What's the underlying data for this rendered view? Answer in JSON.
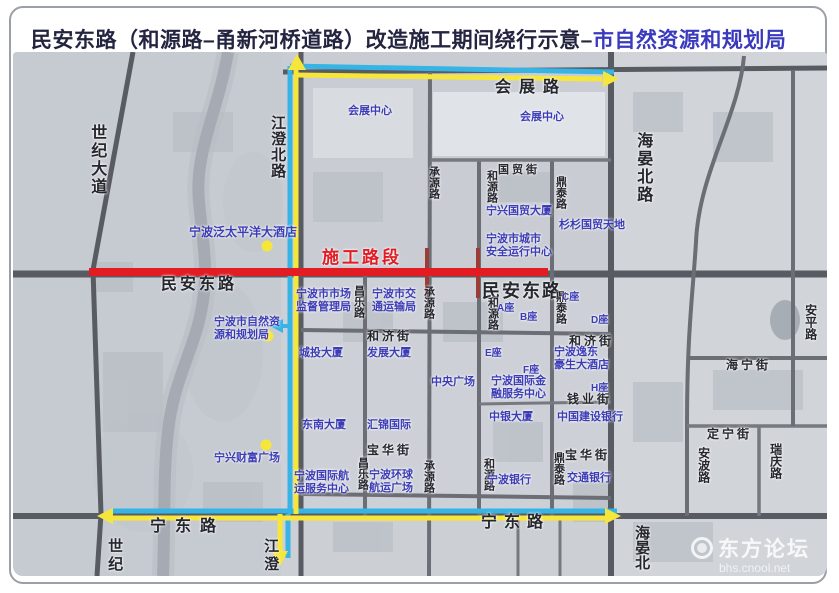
{
  "title": {
    "part1": "民安东路（和源路–甬新河桥道路）改造施工期间绕行示意–",
    "part2": "市自然资源和规划局"
  },
  "colors": {
    "construction_red": "#e31b22",
    "detour_blue": "#35b4e5",
    "detour_yellow": "#f7e63a",
    "road_label": "#26262e",
    "place_label": "#3c3cb6",
    "title_main": "#23243f",
    "title_org": "#3a3abe"
  },
  "watermark": {
    "site_name": "东方论坛",
    "site_url": "bhs.cnool.net"
  },
  "map": {
    "markers": [
      {
        "x": 254,
        "y": 194
      },
      {
        "x": 255,
        "y": 284
      },
      {
        "x": 253,
        "y": 393
      }
    ],
    "labels": [
      {
        "text": "施工路段",
        "x": 309,
        "y": 196,
        "size": 17,
        "kind": "construction",
        "spacing": 3
      },
      {
        "text": "世纪大道",
        "x": 74,
        "y": 72,
        "size": 16,
        "kind": "road",
        "vertical": true,
        "spacing": 2
      },
      {
        "text": "江澄北路",
        "x": 256,
        "y": 63,
        "size": 15,
        "kind": "road",
        "vertical": true,
        "spacing": 1
      },
      {
        "text": "会展路",
        "x": 482,
        "y": 27,
        "size": 16,
        "kind": "road",
        "spacing": 8
      },
      {
        "text": "海晏北路",
        "x": 620,
        "y": 80,
        "size": 16,
        "kind": "road",
        "vertical": true,
        "spacing": 2
      },
      {
        "text": "民安东路",
        "x": 148,
        "y": 224,
        "size": 16,
        "kind": "road",
        "spacing": 3
      },
      {
        "text": "民安东路",
        "x": 469,
        "y": 229,
        "size": 18,
        "kind": "road",
        "spacing": 2,
        "heavy": true
      },
      {
        "text": "宁东路",
        "x": 137,
        "y": 466,
        "size": 16,
        "kind": "road",
        "spacing": 9
      },
      {
        "text": "宁东路",
        "x": 468,
        "y": 462,
        "size": 16,
        "kind": "road",
        "spacing": 7
      },
      {
        "text": "国贸街",
        "x": 485,
        "y": 112,
        "size": 11,
        "kind": "road",
        "spacing": 3
      },
      {
        "text": "承源路",
        "x": 414,
        "y": 114,
        "size": 11,
        "kind": "road",
        "vertical": true
      },
      {
        "text": "和源路",
        "x": 472,
        "y": 118,
        "size": 11,
        "kind": "road",
        "vertical": true
      },
      {
        "text": "鼎泰路",
        "x": 541,
        "y": 124,
        "size": 11,
        "kind": "road",
        "vertical": true
      },
      {
        "text": "昌乐路",
        "x": 339,
        "y": 233,
        "size": 11,
        "kind": "road",
        "vertical": true
      },
      {
        "text": "承源路",
        "x": 409,
        "y": 234,
        "size": 11,
        "kind": "road",
        "vertical": true
      },
      {
        "text": "和源路",
        "x": 473,
        "y": 245,
        "size": 11,
        "kind": "road",
        "vertical": true
      },
      {
        "text": "鼎泰路",
        "x": 541,
        "y": 239,
        "size": 11,
        "kind": "road",
        "vertical": true
      },
      {
        "text": "和济街",
        "x": 354,
        "y": 278,
        "size": 12,
        "kind": "road",
        "spacing": 3
      },
      {
        "text": "和济街",
        "x": 556,
        "y": 283,
        "size": 12,
        "kind": "road",
        "spacing": 3
      },
      {
        "text": "钱业街",
        "x": 554,
        "y": 341,
        "size": 12,
        "kind": "road",
        "spacing": 3
      },
      {
        "text": "宝华街",
        "x": 354,
        "y": 392,
        "size": 12,
        "kind": "road",
        "spacing": 3
      },
      {
        "text": "宝华街",
        "x": 552,
        "y": 397,
        "size": 12,
        "kind": "road",
        "spacing": 3
      },
      {
        "text": "昌乐路",
        "x": 343,
        "y": 405,
        "size": 11,
        "kind": "road",
        "vertical": true
      },
      {
        "text": "承源路",
        "x": 409,
        "y": 408,
        "size": 11,
        "kind": "road",
        "vertical": true
      },
      {
        "text": "和源路",
        "x": 469,
        "y": 406,
        "size": 11,
        "kind": "road",
        "vertical": true
      },
      {
        "text": "鼎泰路",
        "x": 539,
        "y": 400,
        "size": 11,
        "kind": "road",
        "vertical": true
      },
      {
        "text": "海宁街",
        "x": 713,
        "y": 307,
        "size": 12,
        "kind": "road",
        "spacing": 3
      },
      {
        "text": "定宁街",
        "x": 694,
        "y": 376,
        "size": 12,
        "kind": "road",
        "spacing": 3
      },
      {
        "text": "安平路",
        "x": 790,
        "y": 252,
        "size": 12,
        "kind": "road",
        "vertical": true
      },
      {
        "text": "安波路",
        "x": 683,
        "y": 395,
        "size": 12,
        "kind": "road",
        "vertical": true
      },
      {
        "text": "瑞庆路",
        "x": 755,
        "y": 391,
        "size": 12,
        "kind": "road",
        "vertical": true
      },
      {
        "text": "江澄",
        "x": 249,
        "y": 486,
        "size": 15,
        "kind": "road",
        "vertical": true,
        "spacing": 3
      },
      {
        "text": "世纪",
        "x": 93,
        "y": 486,
        "size": 15,
        "kind": "road",
        "vertical": true,
        "spacing": 3
      },
      {
        "text": "海晏北",
        "x": 620,
        "y": 473,
        "size": 15,
        "kind": "road",
        "vertical": true
      },
      {
        "text": "会展中心",
        "x": 335,
        "y": 53,
        "size": 11,
        "kind": "place"
      },
      {
        "text": "会展中心",
        "x": 507,
        "y": 59,
        "size": 11,
        "kind": "place"
      },
      {
        "text": "宁波泛太平洋大酒店",
        "x": 176,
        "y": 174,
        "size": 12,
        "kind": "place"
      },
      {
        "text": "宁兴国贸大厦",
        "x": 473,
        "y": 153,
        "size": 11,
        "kind": "place"
      },
      {
        "text": "杉杉国贸天地",
        "x": 546,
        "y": 167,
        "size": 11,
        "kind": "place"
      },
      {
        "text": "宁波市城市\n安全运行中心",
        "x": 473,
        "y": 181,
        "size": 11,
        "kind": "place"
      },
      {
        "text": "宁波市市场\n监督管理局",
        "x": 283,
        "y": 236,
        "size": 11,
        "kind": "place"
      },
      {
        "text": "宁波市交\n通运输局",
        "x": 359,
        "y": 236,
        "size": 11,
        "kind": "place"
      },
      {
        "text": "宁波市自然资\n源和规划局",
        "x": 201,
        "y": 264,
        "size": 11,
        "kind": "place"
      },
      {
        "text": "城投大厦",
        "x": 286,
        "y": 295,
        "size": 11,
        "kind": "place"
      },
      {
        "text": "发展大厦",
        "x": 354,
        "y": 295,
        "size": 11,
        "kind": "place"
      },
      {
        "text": "中央广场",
        "x": 418,
        "y": 324,
        "size": 11,
        "kind": "place"
      },
      {
        "text": "A座",
        "x": 484,
        "y": 251,
        "size": 10,
        "kind": "place"
      },
      {
        "text": "B座",
        "x": 507,
        "y": 260,
        "size": 10,
        "kind": "place"
      },
      {
        "text": "C座",
        "x": 549,
        "y": 240,
        "size": 10,
        "kind": "place"
      },
      {
        "text": "D座",
        "x": 578,
        "y": 263,
        "size": 10,
        "kind": "place"
      },
      {
        "text": "E座",
        "x": 472,
        "y": 296,
        "size": 10,
        "kind": "place"
      },
      {
        "text": "F座",
        "x": 510,
        "y": 313,
        "size": 10,
        "kind": "place"
      },
      {
        "text": "H座",
        "x": 578,
        "y": 331,
        "size": 10,
        "kind": "place"
      },
      {
        "text": "宁波逸东\n豪生大酒店",
        "x": 541,
        "y": 294,
        "size": 11,
        "kind": "place"
      },
      {
        "text": "宁波国际金\n融服务中心",
        "x": 478,
        "y": 323,
        "size": 11,
        "kind": "place"
      },
      {
        "text": "中银大厦",
        "x": 476,
        "y": 359,
        "size": 11,
        "kind": "place"
      },
      {
        "text": "中国建设银行",
        "x": 544,
        "y": 359,
        "size": 11,
        "kind": "place"
      },
      {
        "text": "东南大厦",
        "x": 289,
        "y": 367,
        "size": 11,
        "kind": "place"
      },
      {
        "text": "汇锦国际",
        "x": 354,
        "y": 367,
        "size": 11,
        "kind": "place"
      },
      {
        "text": "宁兴财富广场",
        "x": 201,
        "y": 400,
        "size": 11,
        "kind": "place"
      },
      {
        "text": "宁波国际航\n运服务中心",
        "x": 281,
        "y": 418,
        "size": 11,
        "kind": "place"
      },
      {
        "text": "宁波环球\n航运广场",
        "x": 356,
        "y": 417,
        "size": 11,
        "kind": "place"
      },
      {
        "text": "宁波银行",
        "x": 474,
        "y": 422,
        "size": 11,
        "kind": "place"
      },
      {
        "text": "交通银行",
        "x": 554,
        "y": 420,
        "size": 11,
        "kind": "place"
      }
    ]
  }
}
